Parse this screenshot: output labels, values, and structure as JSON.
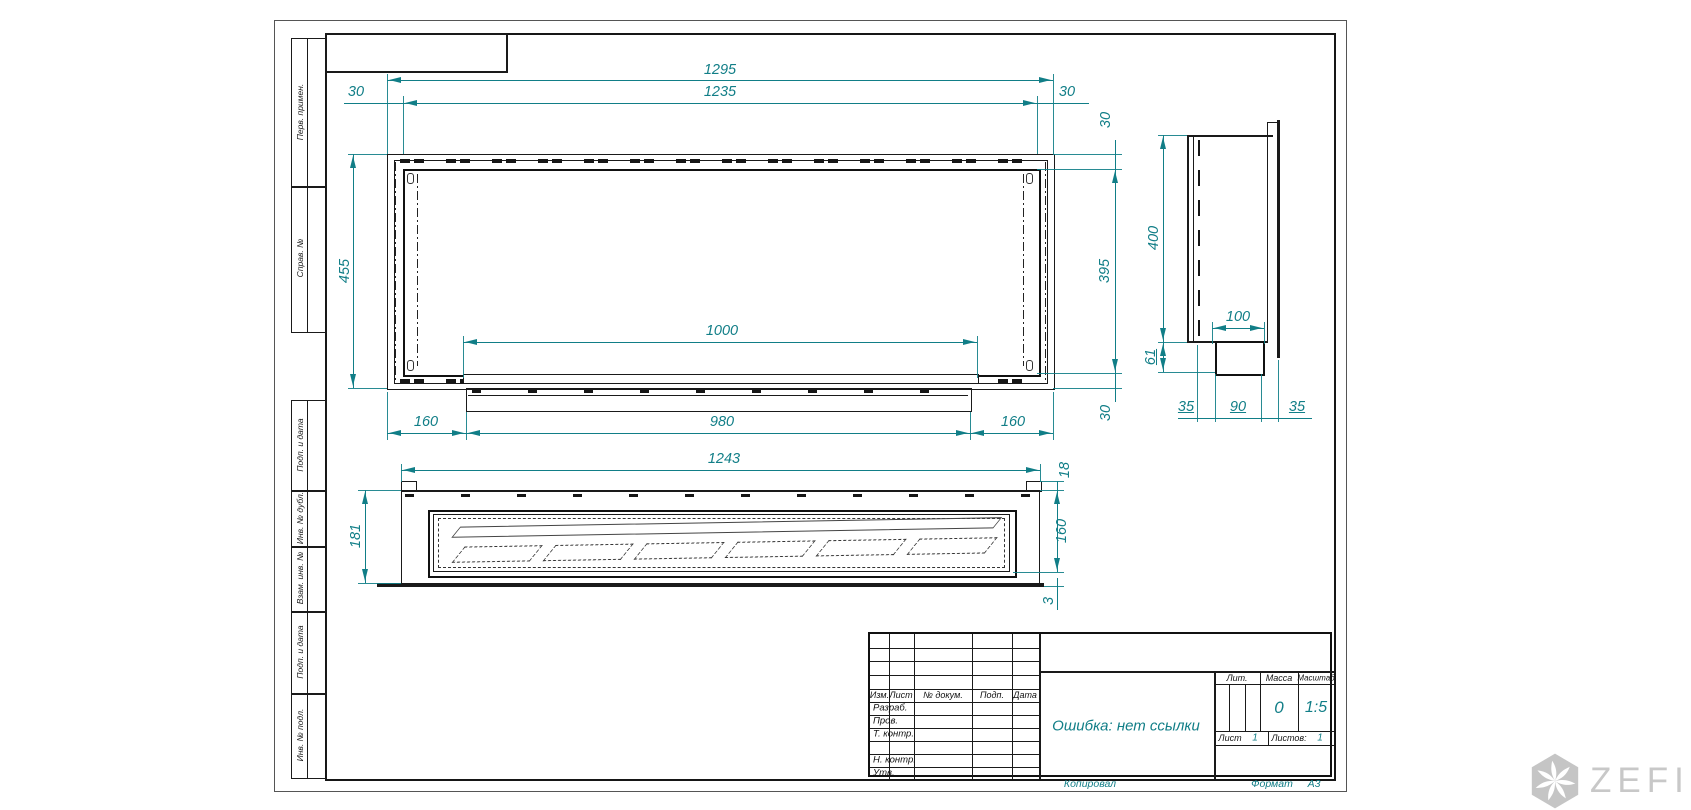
{
  "drawing": {
    "dims": {
      "front": {
        "total_width": "1295",
        "opening_width": "1235",
        "flange_left": "30",
        "flange_right": "30",
        "flange_top": "30",
        "opening_height": "395",
        "flange_bottom": "30",
        "total_height": "455",
        "burner_slot_width": "1000",
        "tray_offset_left": "160",
        "tray_width": "980",
        "tray_offset_right": "160"
      },
      "side": {
        "height": "400",
        "spigot_top_width": "100",
        "spigot_height": "61",
        "wall_offset_left": "35",
        "spigot_width": "90",
        "wall_offset_right": "35"
      },
      "plan": {
        "width": "1243",
        "depth": "181",
        "lip_height": "18",
        "body_depth": "160",
        "base_thickness": "3"
      }
    }
  },
  "margin_stamps": {
    "top_group": [
      {
        "label": "Перв. примен."
      },
      {
        "label": "Справ. №"
      }
    ],
    "bottom_group": [
      {
        "label": "Подп. и дата"
      },
      {
        "label": "Инв. № дубл."
      },
      {
        "label": "Взам. инв. №"
      },
      {
        "label": "Подп. и дата"
      },
      {
        "label": "Инв. № подл."
      }
    ]
  },
  "title_block": {
    "doc_title": "Ошибка: нет ссылки",
    "columns": [
      "Изм.",
      "Лист",
      "№ докум.",
      "Подп.",
      "Дата"
    ],
    "rows": [
      "Разраб.",
      "Пров.",
      "Т. контр.",
      "",
      "Н. контр.",
      "Утв."
    ],
    "lit_label": "Лит.",
    "mass_label": "Масса",
    "scale_label": "Масштаб",
    "mass_value": "0",
    "scale_value": "1:5",
    "sheet_label": "Лист",
    "sheet_value": "1",
    "sheets_label": "Листов:",
    "sheets_value": "1",
    "copied_label": "Копировал",
    "format_label": "Формат",
    "format_value": "А3"
  },
  "watermark": {
    "brand": "ZEFIRE"
  },
  "colors": {
    "ink": "#1a1a1a",
    "dimension": "#117e87",
    "watermark": "#c8c8c8"
  }
}
